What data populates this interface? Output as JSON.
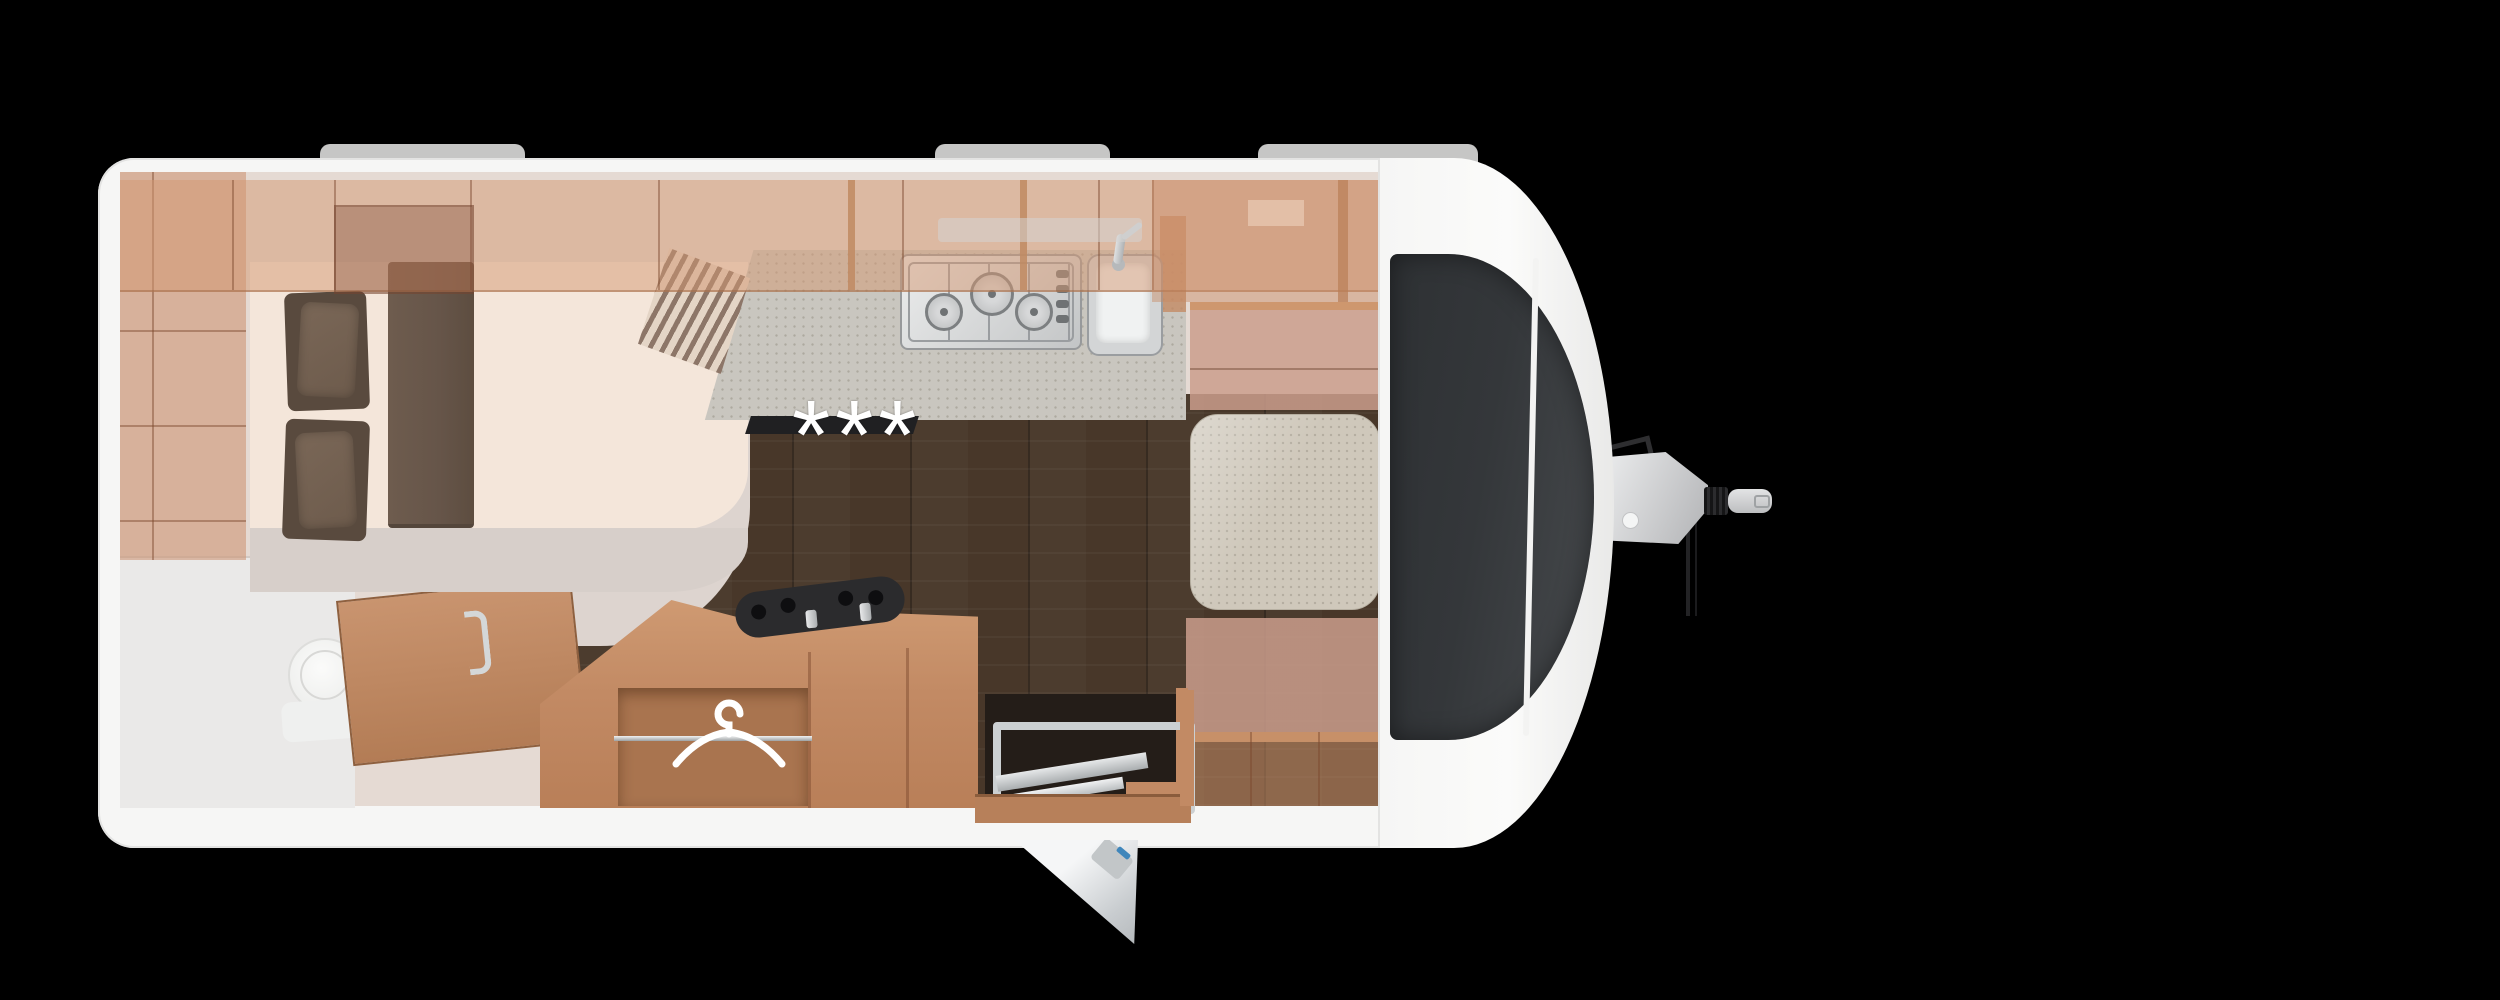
{
  "palette": {
    "background": "#000000",
    "shell": "#f6f6f5",
    "shell_edge": "#e3e3e2",
    "roof_tab": "#c6c6c5",
    "interior": "#e5dad3",
    "wall_light": "#ddd4cf",
    "bath": "#eae9e8",
    "wood_tint": "rgba(212,152,114,0.5)",
    "wood_solid": "#c28a64",
    "wood_deep": "#8a5c3c",
    "wood_seam": "rgba(122,72,44,0.45)",
    "floor": "#483729",
    "mattress": "#f4e6da",
    "platform": "#d7cfca",
    "pillow": "#6d5b4c",
    "pillow_deep": "#594a3e",
    "runner": "#665549",
    "counter": "#c9c6bf",
    "table": "#cfc8bb",
    "bench": "rgba(203,158,140,0.85)",
    "underbench": "rgba(196,140,102,0.55)",
    "panel": "#34373a",
    "panel_light": "#474a4d",
    "bellows": "#151516",
    "accent_blue": "#3f86bb",
    "marking": "#ffffff",
    "step_dark": "#241d18"
  },
  "floorplan": {
    "marking_text": "***",
    "icons": [
      {
        "name": "clothes-hanger-icon"
      },
      {
        "name": "asterisk-floor-marking"
      }
    ],
    "features": {
      "roof_tabs": 3,
      "hob_burners": 3,
      "bed_pillows": 2,
      "front_window_panels": 2,
      "wardrobe_rails": 1
    }
  }
}
